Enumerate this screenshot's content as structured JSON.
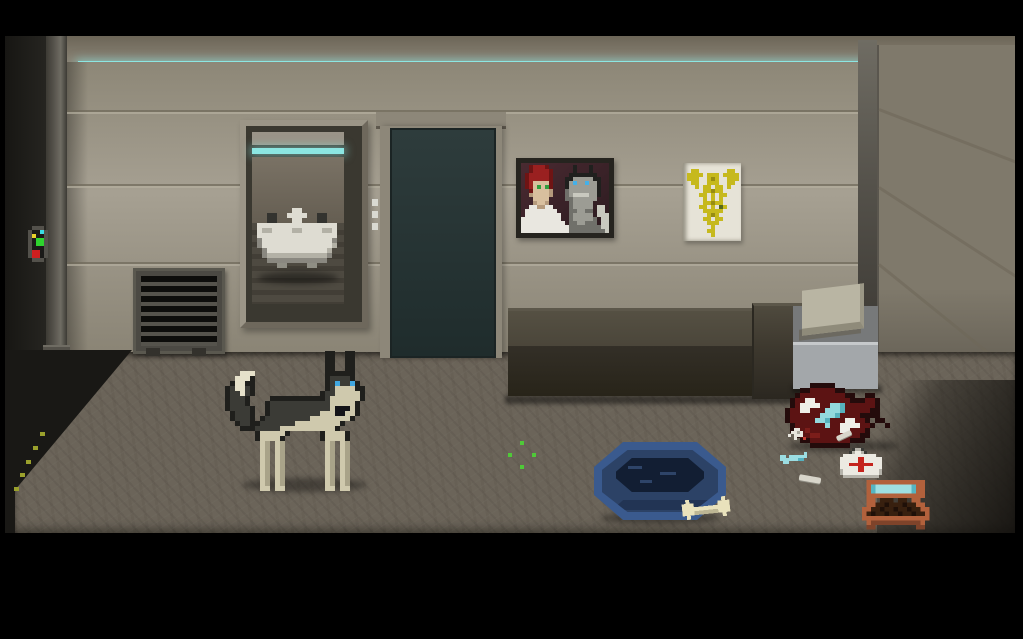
{
  "scene": {
    "title": "pixel-art veterinary clinic room",
    "objects": {
      "dog": "husky dog with blue eyes and collar",
      "door": "closed sliding door",
      "door_panel": "door side indicator panel",
      "sink": "wall sink alcove with mirror and light",
      "portrait": "framed pixel portrait of red-haired woman and grey cat",
      "poster": "veterinary caduceus poster",
      "vent": "floor air vent grate",
      "bench": "dark waiting bench",
      "table": "metal side table with folded towels",
      "bed": "blue dog bed",
      "bone": "dog bone",
      "med_bag": "red medical duffel bag with white crosses",
      "first_aid_kit": "white first aid kit with red cross",
      "feeder": "orange pet food feeder with kibble",
      "syringe": "blue syringe",
      "pills": "spilled pills",
      "cotton_swab": "cotton swab",
      "sparkle": "green interactive hotspot sparkle",
      "control_panel": "wall control panel with status lights",
      "light_strip": "cyan ceiling light strip",
      "caution_stripe": "yellow caution marks on floor edge"
    }
  },
  "palette": {
    "letterbox": "#000000",
    "ceiling_top": "#6c6557",
    "ceiling_bottom": "#8a8476",
    "light_cyan": "#8ce6e2",
    "wall_top": "#8d8777",
    "wall_mid": "#a6a092",
    "wall_bottom": "#8a8475",
    "seam_dark": "#6e6859",
    "seam_light": "#b5af9f",
    "left_wall_dark": "#171613",
    "left_wall_edge": "#262521",
    "pillar_dark": "#3c3a34",
    "pillar_mid": "#54514a",
    "pillar_light": "#6f6c63",
    "floor": "#6b6459",
    "wedge_dark": "#191815",
    "caution_yellow": "#9aa02c",
    "right_wall": "#7f796b",
    "right_wall_dark": "#4b463e",
    "vent_frame": "#4b4943",
    "vent_slat": "#55534c",
    "vent_gap": "#0d0d0b",
    "alcove_frame": "#8f897b",
    "alcove_dark": "#3a3830",
    "door_frame": "#8d8779",
    "door_slab_top": "#2e3c3c",
    "door_slab_bottom": "#1f2c2c",
    "door_dots": "#d9d9d1",
    "poster_bg": "#e6e3d7",
    "bench_top": "#4a4539",
    "bench_front": "#332f27",
    "table_top": "#77797a",
    "table_front": "#a3a7aa",
    "table_edge": "#c6c9cb",
    "towel": "#b9b5a3",
    "towel_shadow": "#6a665c",
    "bed_outer": "#3a5a8e",
    "bed_mid": "#2c4266",
    "bed_inner": "#121e33"
  },
  "sprites": {
    "dog": {
      "key": {
        "K": "#1f1f1c",
        "D": "#3b3b36",
        "C": "#cfc9ad",
        "c": "#a9a389",
        "W": "#e6e1ca",
        "E": "#41a7e0",
        "N": "#141418"
      },
      "grid": [
        ".....................KK..KK...",
        ".....................KK..KK...",
        ".....................KK..KK...",
        ".....................KK..KK...",
        "....WWW..............KKKKKK...",
        "...WWWK..............KDDDDK...",
        "..KWWKK..............KDEDDEK..",
        ".KDWWDK..............KDCCCCKK.",
        ".KDDWDK.............KDDCCCCCK.",
        ".KDDDK....KKKKKKKKKKKDCCCCCCK.",
        ".KDDDK...KDDDDDDDDDDDDCCCCCK..",
        ".KDDDDK..KDDDDDDDDDDDDCNNNCK..",
        "..KDDDK..KDDDDDDDDDDCCCNNCCK..",
        "..KDDDK.KDDDDDDDDDCCCCCCCCK...",
        "...KDDKKDDDDDDDCCCCCCCCCK.....",
        "....KKKDDDDDCCCCCCCCCCCK......",
        ".......KCCCCCK......KCCCCK....",
        ".......KCCCCK.......KCCCCK....",
        "........Cc.Cc........Cc.Cc....",
        "........Cc.Cc........Cc.Cc....",
        "........Cc.Cc........Cc.Cc....",
        "........Cc.Cc........Cc.Cc....",
        "........Cc.Cc........Cc.Cc....",
        "........Cc.Cc........Cc.Cc....",
        "........Cc.Cc........Cc.Cc....",
        "........Cc.Cc........Cc.Cc....",
        "........Cc.Cc........Cc.Cc....",
        "........CC.CC........CC.CC...."
      ]
    },
    "portrait_art": {
      "key": {
        "h": "#6f1414",
        "H": "#9a2020",
        "s": "#d8bf9e",
        "d": "#b59a7c",
        "e": "#2f9e3f",
        "w": "#e9e7e0",
        "g": "#9c9c94",
        "G": "#70706a",
        "b": "#45b0e8",
        "k": "#20201e",
        "m": "#c9c9bf"
      },
      "grid": [
        "..hHHHh......k...k....",
        "..hHHHHh.....k...k....",
        ".hHHHHHh....kkkkkkk...",
        ".hHHHHHh...kkgggggkk..",
        ".hHssssh...kgbggbggk..",
        ".hHseseh...kgggggggk..",
        "..hssssd...Ggggggggk..",
        "..dssssd...Ggmmmmggk..",
        "...ssss....GGgggggg...",
        "...dssd.....Gggggg....",
        "..wwddww....Gggggg.mm.",
        ".wwwwwwww...GGggGG.mm.",
        ".wwwwwwwww..Gggggg.mmm",
        "wwwwwwwwww..GgggggG.mm",
        "wwwwwwwwwww.GGggGGG.mm",
        "wwwwwwwwwwwwGGGGGGGGmm",
        "wwwwwwwwwwwwGGGGGGGGGm"
      ]
    },
    "caduceus": {
      "key": {
        "y": "#c6b91d",
        "o": "#978c12",
        "g": "#55681c"
      },
      "grid": [
        ".yy.......yy.",
        "yyyy.yyy.yyyy",
        "yyy..yoy..yyy",
        ".yy..yyy..yy.",
        "..y.yy.yy.y..",
        "....yyoyy....",
        "...yy.y.yy...",
        "....y.y.y....",
        "....yyoyy....",
        "...yy.y.gy...",
        "....yyyyy....",
        ".....yoy.....",
        "....yy.yy....",
        ".....yyy.....",
        "......y......",
        ".....yy......",
        "......y......"
      ]
    },
    "sink": {
      "key": {
        "w": "#dedcd2",
        "d": "#b3b1a6",
        "k": "#33332f",
        "g": "#8f8e84",
        "D": "#8a8880"
      },
      "grid": [
        "........ww........",
        "...kk..wwww..kk...",
        "...kk...ww...kk...",
        ".wwwwwwwwwwwwwwww.",
        ".wddwwwwddwwwwddw.",
        ".wwwwwwwwwwwwwwww.",
        ".DwwwwwwwwwwwwwwD.",
        ".Dwwwwwwwwwwwwwwd.",
        "..Dwwwwwwwwwwwwd..",
        "..DddddddddddddD..",
        "...DDDDDDDDDDDD...",
        ".....gg....gg....."
      ]
    },
    "med_bag": {
      "key": {
        "k": "#240b0b",
        "r": "#5c1313",
        "R": "#7b1d1a",
        "w": "#efeee8",
        "c": "#93d9dd",
        "C": "#57b1bd"
      },
      "grid": [
        "......kkkkk.............",
        "....kkrrrrrkk...........",
        "...krrrrrrrrrkk..kk.....",
        "..krrwwrrrrrrrkkkrrk....",
        "..krwwwwrrccCrrrrrrk....",
        ".krrwwrrrcccCrrrrrkk....",
        ".krrrrrrcccCrrrrkkkk....",
        ".krrrrrccCrrrwwrrk.kk...",
        "..krrrrrrcrrwwwwrrk..k..",
        "..krrRrrrrrrwwrrrk......",
        "...krrRRrrrrrrrrkk......",
        "....kkrrrrrrrrkkk.......",
        "......kkkkkkkk.........."
      ]
    },
    "first_aid_kit": {
      "key": {
        "w": "#eceae2",
        "d": "#b5b3aa",
        "r": "#c4241d",
        "k": "#3a3a36"
      },
      "grid": [
        "....kddk......",
        "...kdwwdk.....",
        ".wwwwwwwwwww..",
        "wwwwwwrrwwwwww",
        "wwwwwwrrwwwwww",
        "wwwrrrrrrrrwww",
        "wwwwwwrrwwwwww",
        "dwwwwwrrwwwwwd",
        "dwwwwwwwwwwwwd",
        ".dddddddddddd."
      ]
    },
    "feeder": {
      "key": {
        "o": "#b2613c",
        "O": "#7e432a",
        "c": "#9fdfe2",
        "C": "#56b5c2",
        "k": "#38200f",
        "K": "#1f1008"
      },
      "grid": [
        ".ooooooooooooo.",
        ".oCccccccccCoo.",
        ".oCccccccccCoo.",
        ".ooooooooooooo.",
        ".oo.kkk.kk.oo..",
        ".ookkKkkkKkkoo.",
        "ookkKkkKkkKkkoo",
        "okKkkKkkKkkKkko",
        "ooooooooooooooo",
        ".oOOOOOOOOOOOo.",
        ".OO.........OO."
      ]
    },
    "bone": {
      "key": {
        "C": "#e9e2bc",
        "d": "#bdb694"
      },
      "grid": [
        ".C........C.",
        "CCC......CCC",
        "CCCCCCCCCCCC",
        "CCCddddddCCC",
        ".C........C."
      ]
    },
    "panel_lights": {
      "key": {
        "p": "#53514b",
        "k": "#1a1a18",
        "c": "#39dce4",
        "y": "#e8d22a",
        "g": "#2ed32e",
        "r": "#cf1f1f"
      },
      "grid": [
        "..ppp.",
        ".pkkcp",
        ".pykkp",
        ".pkggp",
        ".pkggp",
        ".pkkkp",
        ".prrkp",
        ".prrkp",
        "..ppp."
      ]
    },
    "sparkle": {
      "key": {
        "g": "#4fc938"
      },
      "grid": [
        "...g...",
        ".......",
        ".......",
        "g.....g",
        ".......",
        ".......",
        "...g..."
      ]
    },
    "syringe": {
      "key": {
        "c": "#9bdde2",
        "C": "#55b2c0"
      },
      "grid": [
        "........c.",
        "cc.cccccc.",
        "ccccccCC..",
        ".cc......."
      ]
    },
    "pills": {
      "key": {
        "w": "#e8e6de",
        "r": "#c23a30",
        "d": "#a8a69c"
      },
      "grid": [
        "..ww..",
        ".wwdw.",
        "w.www.",
        "..w..r"
      ]
    }
  }
}
